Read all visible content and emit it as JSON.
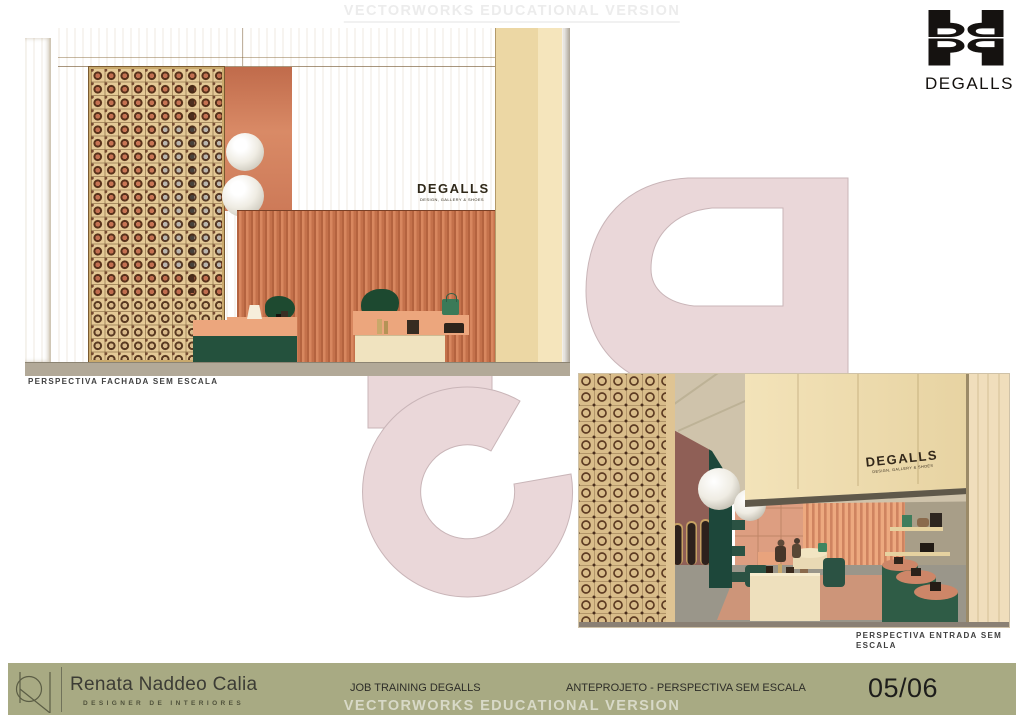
{
  "watermarks": {
    "top": "VECTORWORKS EDUCATIONAL VERSION",
    "bottom": "VECTORWORKS EDUCATIONAL VERSION"
  },
  "brand": {
    "logo_icon": "degalls-monogram",
    "wordmark": "DEGALLS",
    "sign_title": "DEGALLS",
    "sign_subtitle": "DESIGN, GALLERY & SHOES"
  },
  "views": {
    "facade": {
      "caption": "PERSPECTIVA FACHADA SEM ESCALA"
    },
    "entrance": {
      "caption_line1": "PERSPECTIVA ENTRADA SEM",
      "caption_line2": "ESCALA"
    }
  },
  "footer": {
    "designer_name": "Renata Naddeo Calia",
    "designer_title": "DESIGNER DE INTERIORES",
    "project": "JOB TRAINING DEGALLS",
    "stage": "ANTEPROJETO - PERSPECTIVA SEM ESCALA",
    "page": "05/06"
  },
  "colors": {
    "footer_bar": "#a8aa83",
    "watermark_pink": "#ead7d9",
    "coral_wall": "#cd7a5a",
    "wood_panel": "#f2e0b2",
    "display_green": "#2b5243"
  }
}
